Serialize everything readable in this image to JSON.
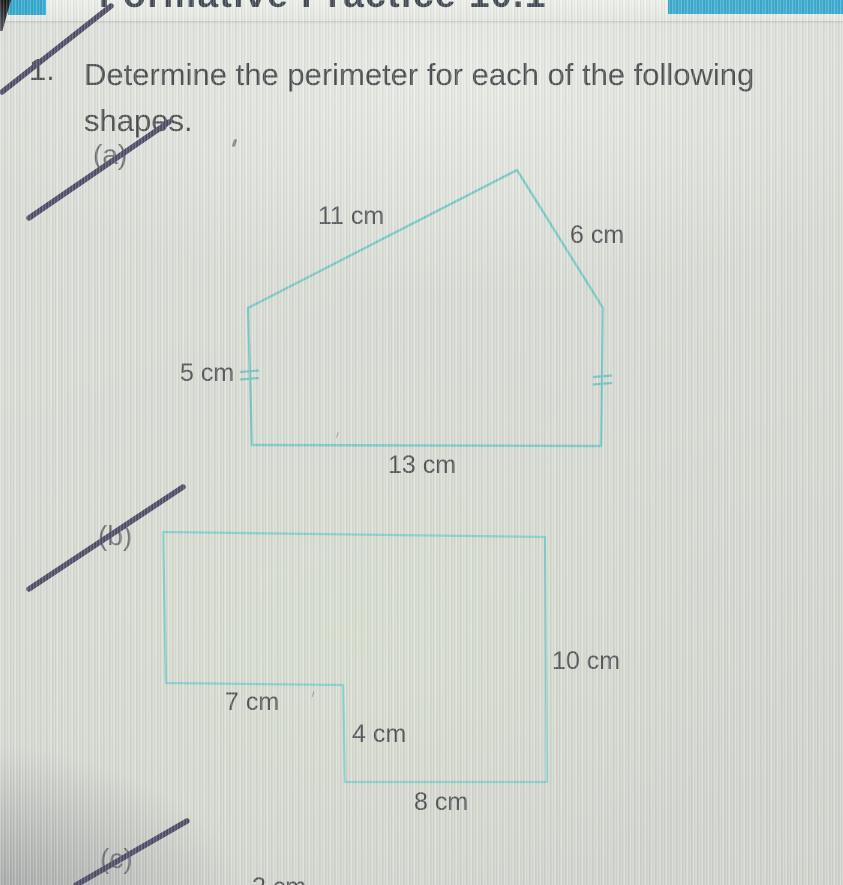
{
  "header": {
    "cropped_title": "Formative Practice 10.1",
    "accent_color": "#2fa9cf"
  },
  "question": {
    "number": "1.",
    "line1": "Determine the perimeter for each of the following",
    "line2": "shapes."
  },
  "parts": {
    "a": "(a)",
    "b": "(b)",
    "c": "(c)"
  },
  "shape_a": {
    "type": "pentagon",
    "outline_color": "#79c9c8",
    "labels": {
      "top_slant": "11 cm",
      "right_slant": "6 cm",
      "left_side": "5 cm",
      "bottom": "13 cm"
    },
    "equal_tick_sides": [
      "left",
      "right"
    ]
  },
  "shape_b": {
    "type": "l-shape",
    "outline_color": "#84cfcd",
    "labels": {
      "step_horizontal": "7 cm",
      "step_vertical": "4 cm",
      "bottom": "8 cm",
      "right_side": "10 cm"
    }
  },
  "part_c_preview": {
    "partial_label": "2 cm"
  },
  "pen": {
    "color": "#4a4562",
    "struck_items": [
      "question-number",
      "part-a",
      "part-b",
      "part-c"
    ]
  }
}
